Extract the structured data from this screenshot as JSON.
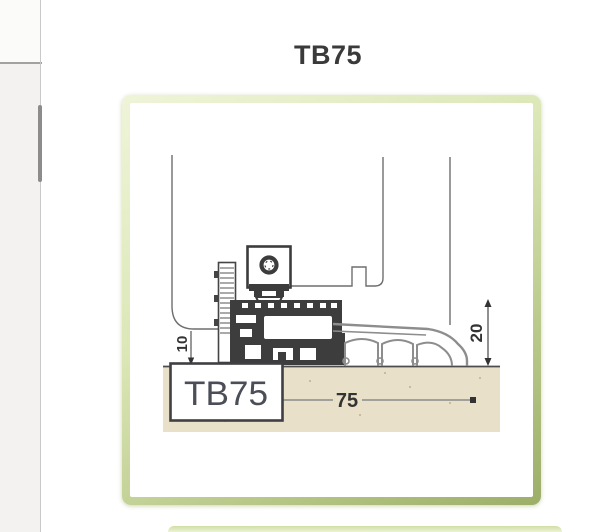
{
  "page": {
    "title": "TB75"
  },
  "diagram": {
    "label_box_text": "TB75",
    "dimensions": {
      "width": "75",
      "height": "20",
      "offset": "10"
    }
  },
  "colors": {
    "frame_border_green": "#b7c787",
    "ground_beige": "#e8e0c8",
    "profile_dark": "#3d3d3d",
    "ramp_gray": "#8d8d8d",
    "title_text": "#3a3a3a"
  }
}
